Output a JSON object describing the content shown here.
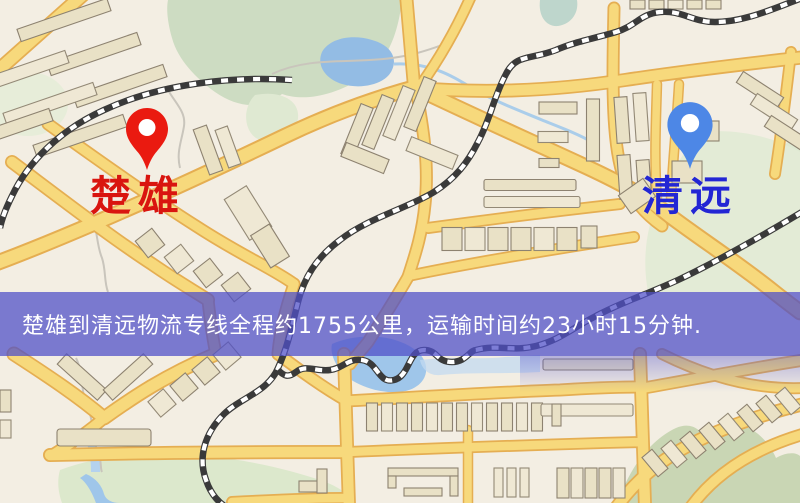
{
  "markers": {
    "origin": {
      "label": "楚雄",
      "label_color": "#d9150f",
      "pin_color": "#ea1a10"
    },
    "destination": {
      "label": "清远",
      "label_color": "#2326d4",
      "pin_color": "#4d87e6"
    }
  },
  "banner": {
    "text": "楚雄到清远物流专线全程约1755公里，运输时间约23小时15分钟.",
    "background_color": "#5050c8",
    "text_color": "#ffffff",
    "route": {
      "origin": "楚雄",
      "destination": "清远",
      "distance": "约1755公里",
      "duration": "约23小时15分钟"
    }
  },
  "map": {
    "style_colors": {
      "background": "#f3eee3",
      "road_fill": "#f7d97c",
      "road_casing": "#e5ae52",
      "building": "#e9e1c6",
      "water": "#9fc6ea",
      "green_area": "#cddcc2",
      "railway": "#3a3a3a"
    }
  }
}
